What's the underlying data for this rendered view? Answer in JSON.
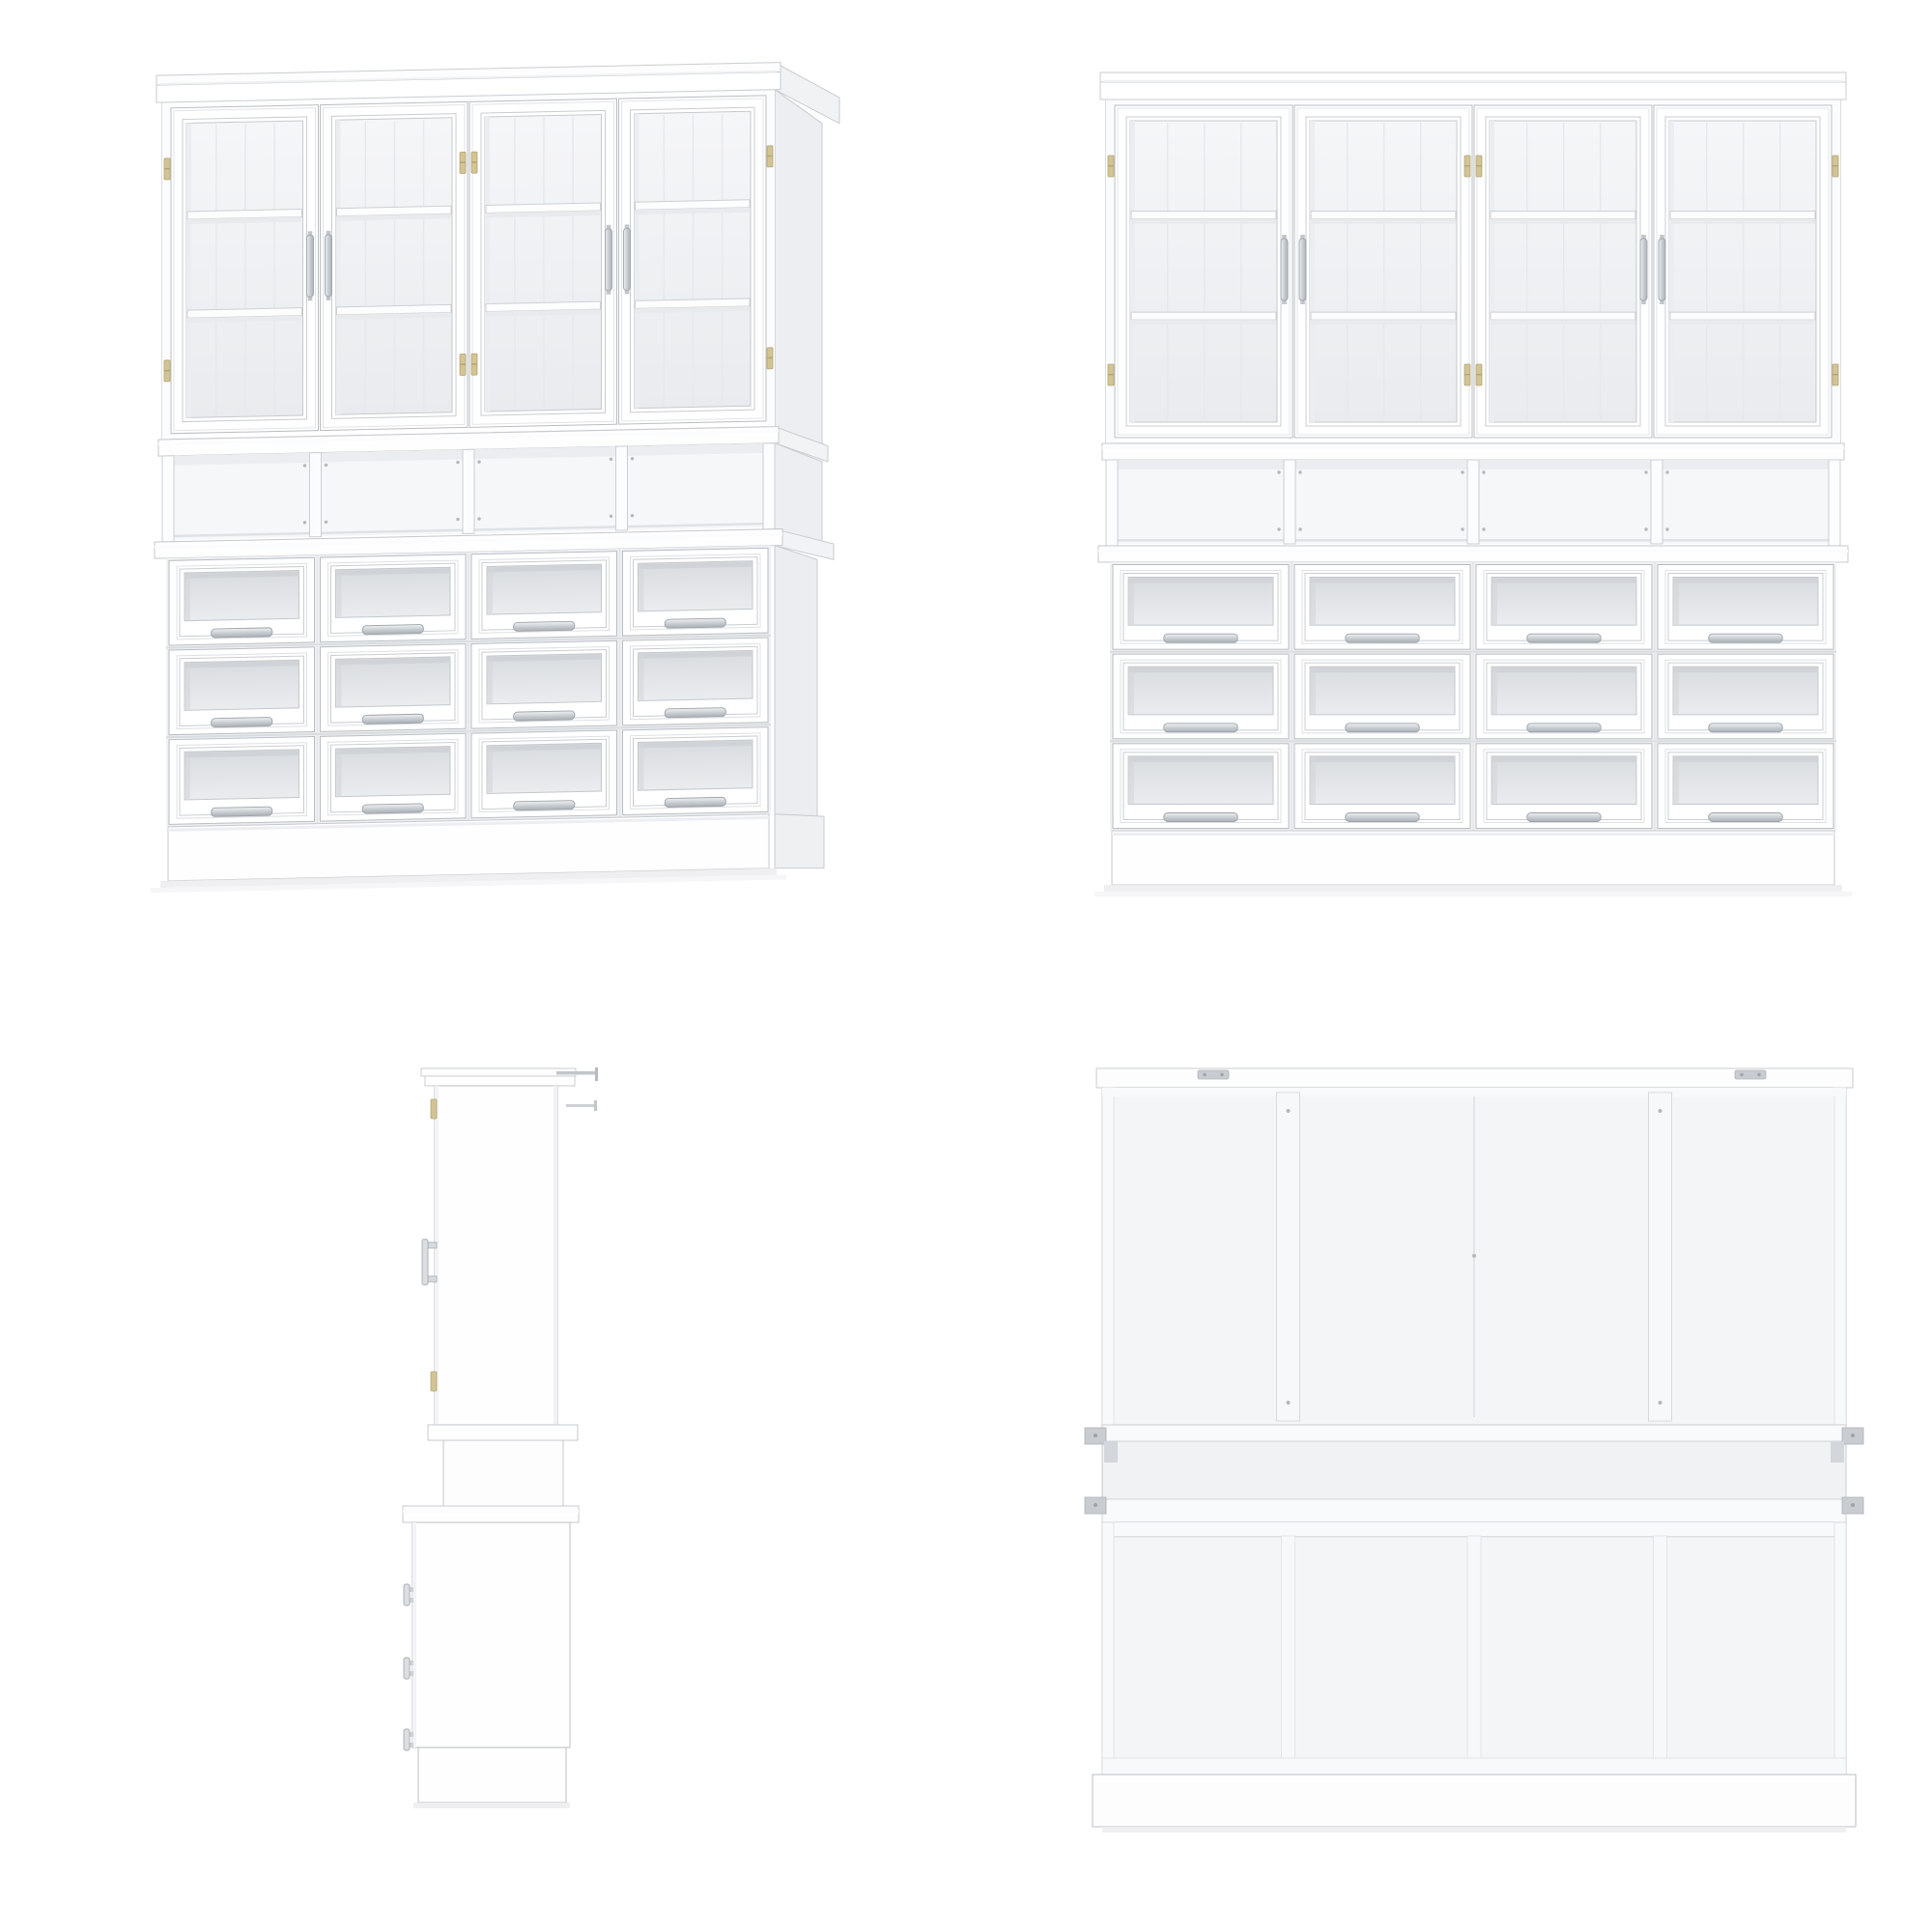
{
  "page": {
    "background": "#ffffff",
    "content_type": "furniture-product-render-sheet"
  },
  "product": {
    "name": "white-glass-door-hutch-display-cabinet",
    "views": [
      {
        "id": "perspective",
        "label": "front-perspective-view",
        "position": "top-left"
      },
      {
        "id": "front",
        "label": "front-view",
        "position": "top-right"
      },
      {
        "id": "side",
        "label": "side-profile-view",
        "position": "bottom-left"
      },
      {
        "id": "back",
        "label": "back-view",
        "position": "bottom-right"
      }
    ],
    "structure": {
      "upper": {
        "glass_doors": 4,
        "shelves_per_door": 2,
        "handle_pairs": 2,
        "hinge_columns": 3,
        "hinge_finish": "brass"
      },
      "middle": {
        "open_cubbies": 4,
        "dividers": 3,
        "divider_screws": true
      },
      "lower": {
        "drawer_rows": 3,
        "drawer_cols": 4,
        "drawers_total": 12,
        "glass_front": true,
        "pull_style": "metal-bar"
      },
      "base": {
        "type": "plinth"
      },
      "back": {
        "vertical_seams": 3,
        "battens": 2,
        "mount_brackets": 4,
        "top_brackets": 2
      }
    },
    "colors": {
      "white": "#ffffff",
      "edge": "#c6c9cd",
      "edgeDark": "#b9bdc2",
      "frameLine": "#d6d9dc",
      "glassU1": "#f5f6f8",
      "glassU2": "#e9ebee",
      "glassD1": "#d9dcdf",
      "glassD2": "#eaecee",
      "interior": "#f4f5f7",
      "interiorShade": "#ebedf0",
      "plank": "#e6e8eb",
      "shelfEdge": "#ccd0d4",
      "shelfShadow": "#e8eaed",
      "hinge": "#d3c493",
      "hingeEdge": "#b2a476",
      "metalEdge": "#a0a6ac",
      "sidePanel": "#eef0f2",
      "sideDark": "#eceef1",
      "seam": "#dcdee1",
      "batten": "#f7f8fa",
      "bracket": "#c9ccd0",
      "screw": "#b4b8be",
      "shadow": "#ececee",
      "cubbyBack": "#f6f7f9",
      "counter": "#fefeff"
    }
  }
}
